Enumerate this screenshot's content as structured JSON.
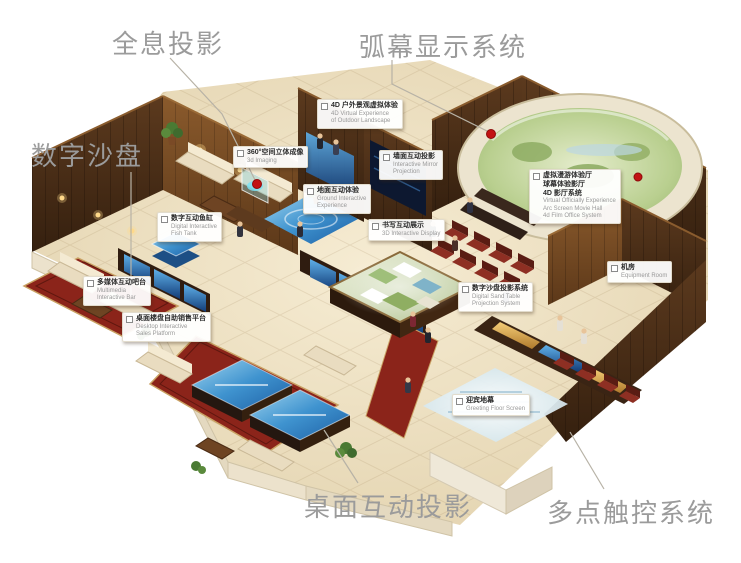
{
  "image": {
    "background": "#ffffff",
    "description": "Isometric rendering of a digital exhibition hall with annotated interactive display systems"
  },
  "colors": {
    "label_text": "#9b9b9b",
    "marker_red": "#c21313",
    "wall_wood": "#5a3419",
    "floor_beige": "#e9dcbd",
    "screen_blue": "#2e7fc0",
    "carpet_red": "#8b241a",
    "dome_green": "#a9c27f"
  },
  "main_labels": {
    "holography": "全息投影",
    "arc_screen": "弧幕显示系统",
    "sand_table": "数字沙盘",
    "desktop_projection": "桌面互动投影",
    "multitouch": "多点触控系统"
  },
  "callouts": [
    {
      "id": "outdoor-4d",
      "zh": [
        "4D 户外景观虚拟体验"
      ],
      "en": [
        "4D Virtual Experience",
        "of Outdoor Landscape"
      ]
    },
    {
      "id": "imaging-360",
      "zh": [
        "360°空间立体成像"
      ],
      "en": [
        "3d Imaging"
      ]
    },
    {
      "id": "wall-projection",
      "zh": [
        "墙面互动投影"
      ],
      "en": [
        "Interactive Mirror",
        "Projection"
      ]
    },
    {
      "id": "vr-theater",
      "zh": [
        "虚拟漫游体验厅",
        "球幕体验影厅",
        "4D 影厅系统"
      ],
      "en": [
        "Virtual Officially Experience",
        "Arc Screen Movie Hall",
        "4d Film Office System"
      ]
    },
    {
      "id": "fish-tank",
      "zh": [
        "数字互动鱼缸"
      ],
      "en": [
        "Digital Interactive",
        "Fish Tank"
      ]
    },
    {
      "id": "ground-interactive",
      "zh": [
        "地面互动体验"
      ],
      "en": [
        "Ground Interactive",
        "Experience"
      ]
    },
    {
      "id": "writing-display",
      "zh": [
        "书写互动展示"
      ],
      "en": [
        "3D Interactive Display"
      ]
    },
    {
      "id": "multimedia-bar",
      "zh": [
        "多媒体互动吧台"
      ],
      "en": [
        "Multimedia",
        "Interactive Bar"
      ]
    },
    {
      "id": "desktop-sales",
      "zh": [
        "桌面楼盘自助销售平台"
      ],
      "en": [
        "Desktop Interactive",
        "Sales Platform"
      ]
    },
    {
      "id": "sand-projection",
      "zh": [
        "数字沙盘投影系统"
      ],
      "en": [
        "Digital Sand Table",
        "Projection System"
      ]
    },
    {
      "id": "greeting-floor",
      "zh": [
        "迎宾地幕"
      ],
      "en": [
        "Greeting Floor Screen"
      ]
    },
    {
      "id": "equipment-room",
      "zh": [
        "机房"
      ],
      "en": [
        "Equipment Room"
      ]
    }
  ]
}
